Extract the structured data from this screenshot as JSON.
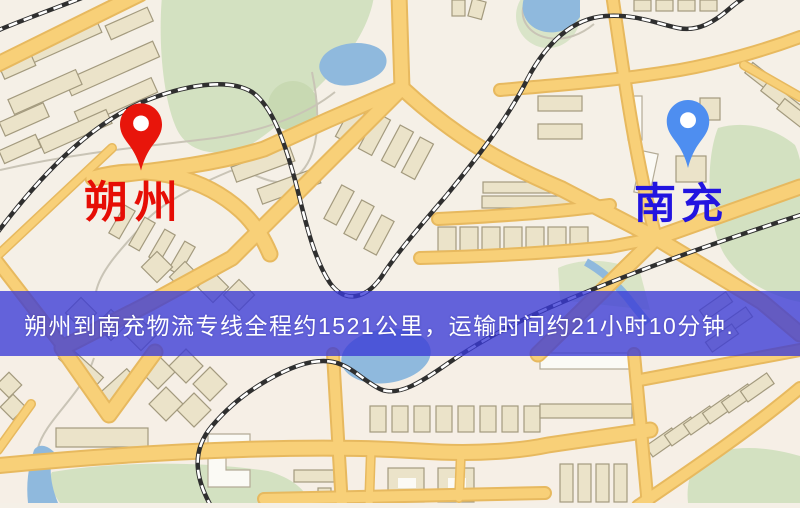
{
  "map": {
    "origin": {
      "label": "朔州",
      "pin_color": "#e8150b",
      "label_color": "#e60d05"
    },
    "destination": {
      "label": "南充",
      "pin_color": "#4e8ef0",
      "label_color": "#2214e0"
    },
    "banner": {
      "text": "朔州到南充物流专线全程约1521公里，运输时间约21小时10分钟.",
      "bg_color": "rgba(58,58,214,0.78)",
      "text_color": "#ffffff"
    },
    "route": {
      "distance_km": 1521,
      "duration_text": "21小时10分钟"
    },
    "palette": {
      "land": "#f5f0e7",
      "road_fill": "#f8d078",
      "road_casing": "#e7b95f",
      "park_green": "#d3e1c1",
      "water_blue": "#8fb9dd",
      "railway_dark": "#2f2f2f",
      "building_fill": "#ebe3c9"
    }
  }
}
